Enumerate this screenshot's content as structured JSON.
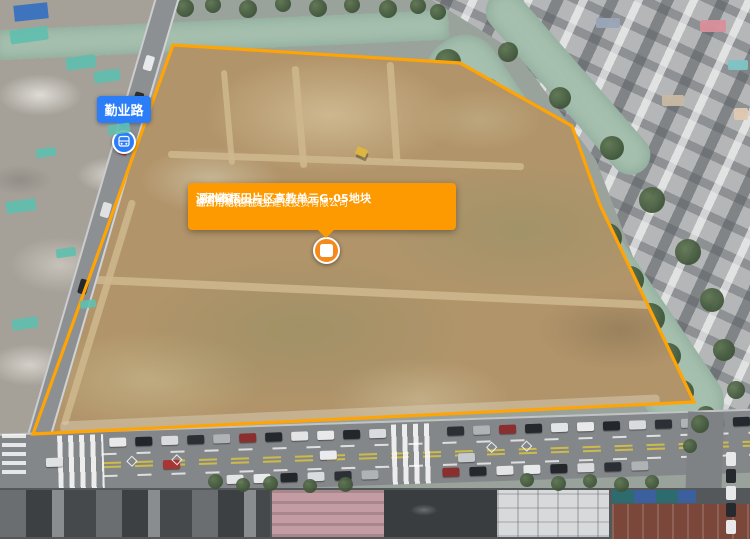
{
  "map": {
    "road_label": {
      "text": "勤业路",
      "icon": "bus-icon"
    },
    "parcel": {
      "tooltip": {
        "title": "温州市梧田片区高教单元G-05地块",
        "status": "(已成交)",
        "sale_method": "(招拍挂)",
        "land_use": "综合用地(含住宅)",
        "divider": "|",
        "owner": "温州市新龙商贸业建设投资有限公司"
      },
      "marker_icon": "parcel-grid-icon",
      "polygon_points": "173,45 460,63 572,126 600,205 694,402 33,434"
    }
  },
  "colors": {
    "accent_orange": "#fd9a01",
    "polygon_stroke": "#ffa405",
    "marker_orange": "#f5891c",
    "label_blue": "#2c7ef8"
  }
}
